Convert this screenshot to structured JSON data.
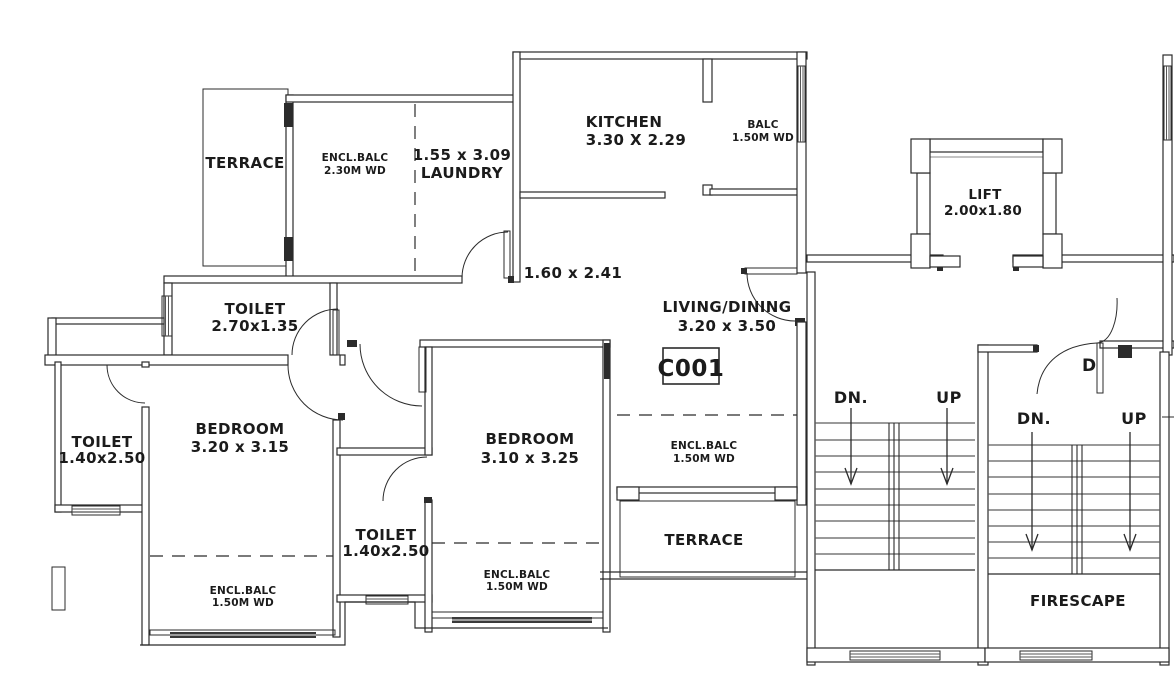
{
  "plan": {
    "unit": "C001",
    "door_tag": "D",
    "rooms": {
      "terrace_top": [
        "TERRACE"
      ],
      "encl_balc_top": [
        "ENCL.BALC",
        "2.30M WD"
      ],
      "laundry": [
        "1.55 x 3.09",
        "LAUNDRY"
      ],
      "kitchen": [
        "KITCHEN",
        "3.30 X 2.29"
      ],
      "balc": [
        "BALC",
        "1.50M WD"
      ],
      "lift": [
        "LIFT",
        "2.00x1.80"
      ],
      "passage": [
        "1.60 x 2.41"
      ],
      "toilet_common": [
        "TOILET",
        "2.70x1.35"
      ],
      "living": [
        "LIVING/DINING",
        "3.20 x 3.50"
      ],
      "toilet_left": [
        "TOILET",
        "1.40x2.50"
      ],
      "bedroom_left": [
        "BEDROOM",
        "3.20 x 3.15"
      ],
      "bedroom_mid": [
        "BEDROOM",
        "3.10 x 3.25"
      ],
      "encl_balc_living": [
        "ENCL.BALC",
        "1.50M WD"
      ],
      "toilet_mid": [
        "TOILET",
        "1.40x2.50"
      ],
      "encl_balc_bed_left": [
        "ENCL.BALC",
        "1.50M WD"
      ],
      "encl_balc_bed_mid": [
        "ENCL.BALC",
        "1.50M WD"
      ],
      "terrace_right": [
        "TERRACE"
      ],
      "firescape": [
        "FIRESCAPE"
      ]
    },
    "stairs": {
      "main": {
        "down": "DN.",
        "up": "UP"
      },
      "fire": {
        "down": "DN.",
        "up": "UP"
      }
    },
    "colors": {
      "line": "#2b2b2b",
      "background": "#ffffff"
    }
  }
}
